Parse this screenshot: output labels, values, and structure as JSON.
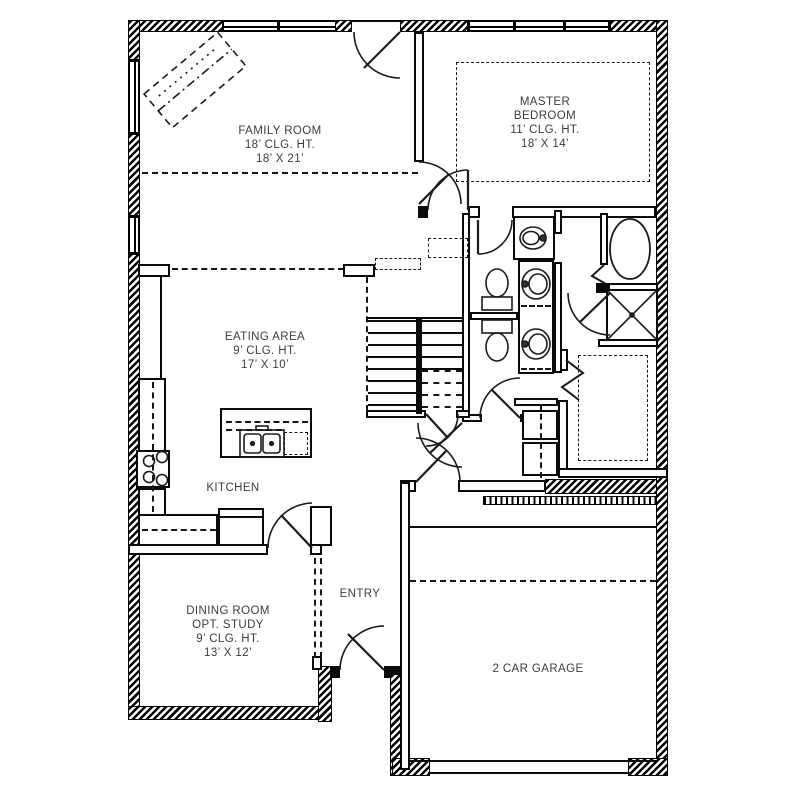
{
  "meta": {
    "drawing_type": "residential first floor plan"
  },
  "colors": {
    "wall": "#000000",
    "label_text": "#3c3c3c",
    "background": "#ffffff"
  },
  "rooms": {
    "family_room": {
      "lines": [
        "FAMILY ROOM",
        "18’ CLG. HT.",
        "18’ X 21’"
      ]
    },
    "master_bedroom": {
      "lines": [
        "MASTER",
        "BEDROOM",
        "11’ CLG. HT.",
        "18’ X 14’"
      ]
    },
    "eating_area": {
      "lines": [
        "EATING AREA",
        "9’ CLG. HT.",
        "17’ X 10’"
      ]
    },
    "kitchen": {
      "lines": [
        "KITCHEN"
      ]
    },
    "dining_room": {
      "lines": [
        "DINING ROOM",
        "OPT. STUDY",
        "9’ CLG. HT.",
        "13’ X 12’"
      ]
    },
    "entry": {
      "lines": [
        "ENTRY"
      ]
    },
    "garage": {
      "lines": [
        "2 CAR GARAGE"
      ]
    }
  }
}
